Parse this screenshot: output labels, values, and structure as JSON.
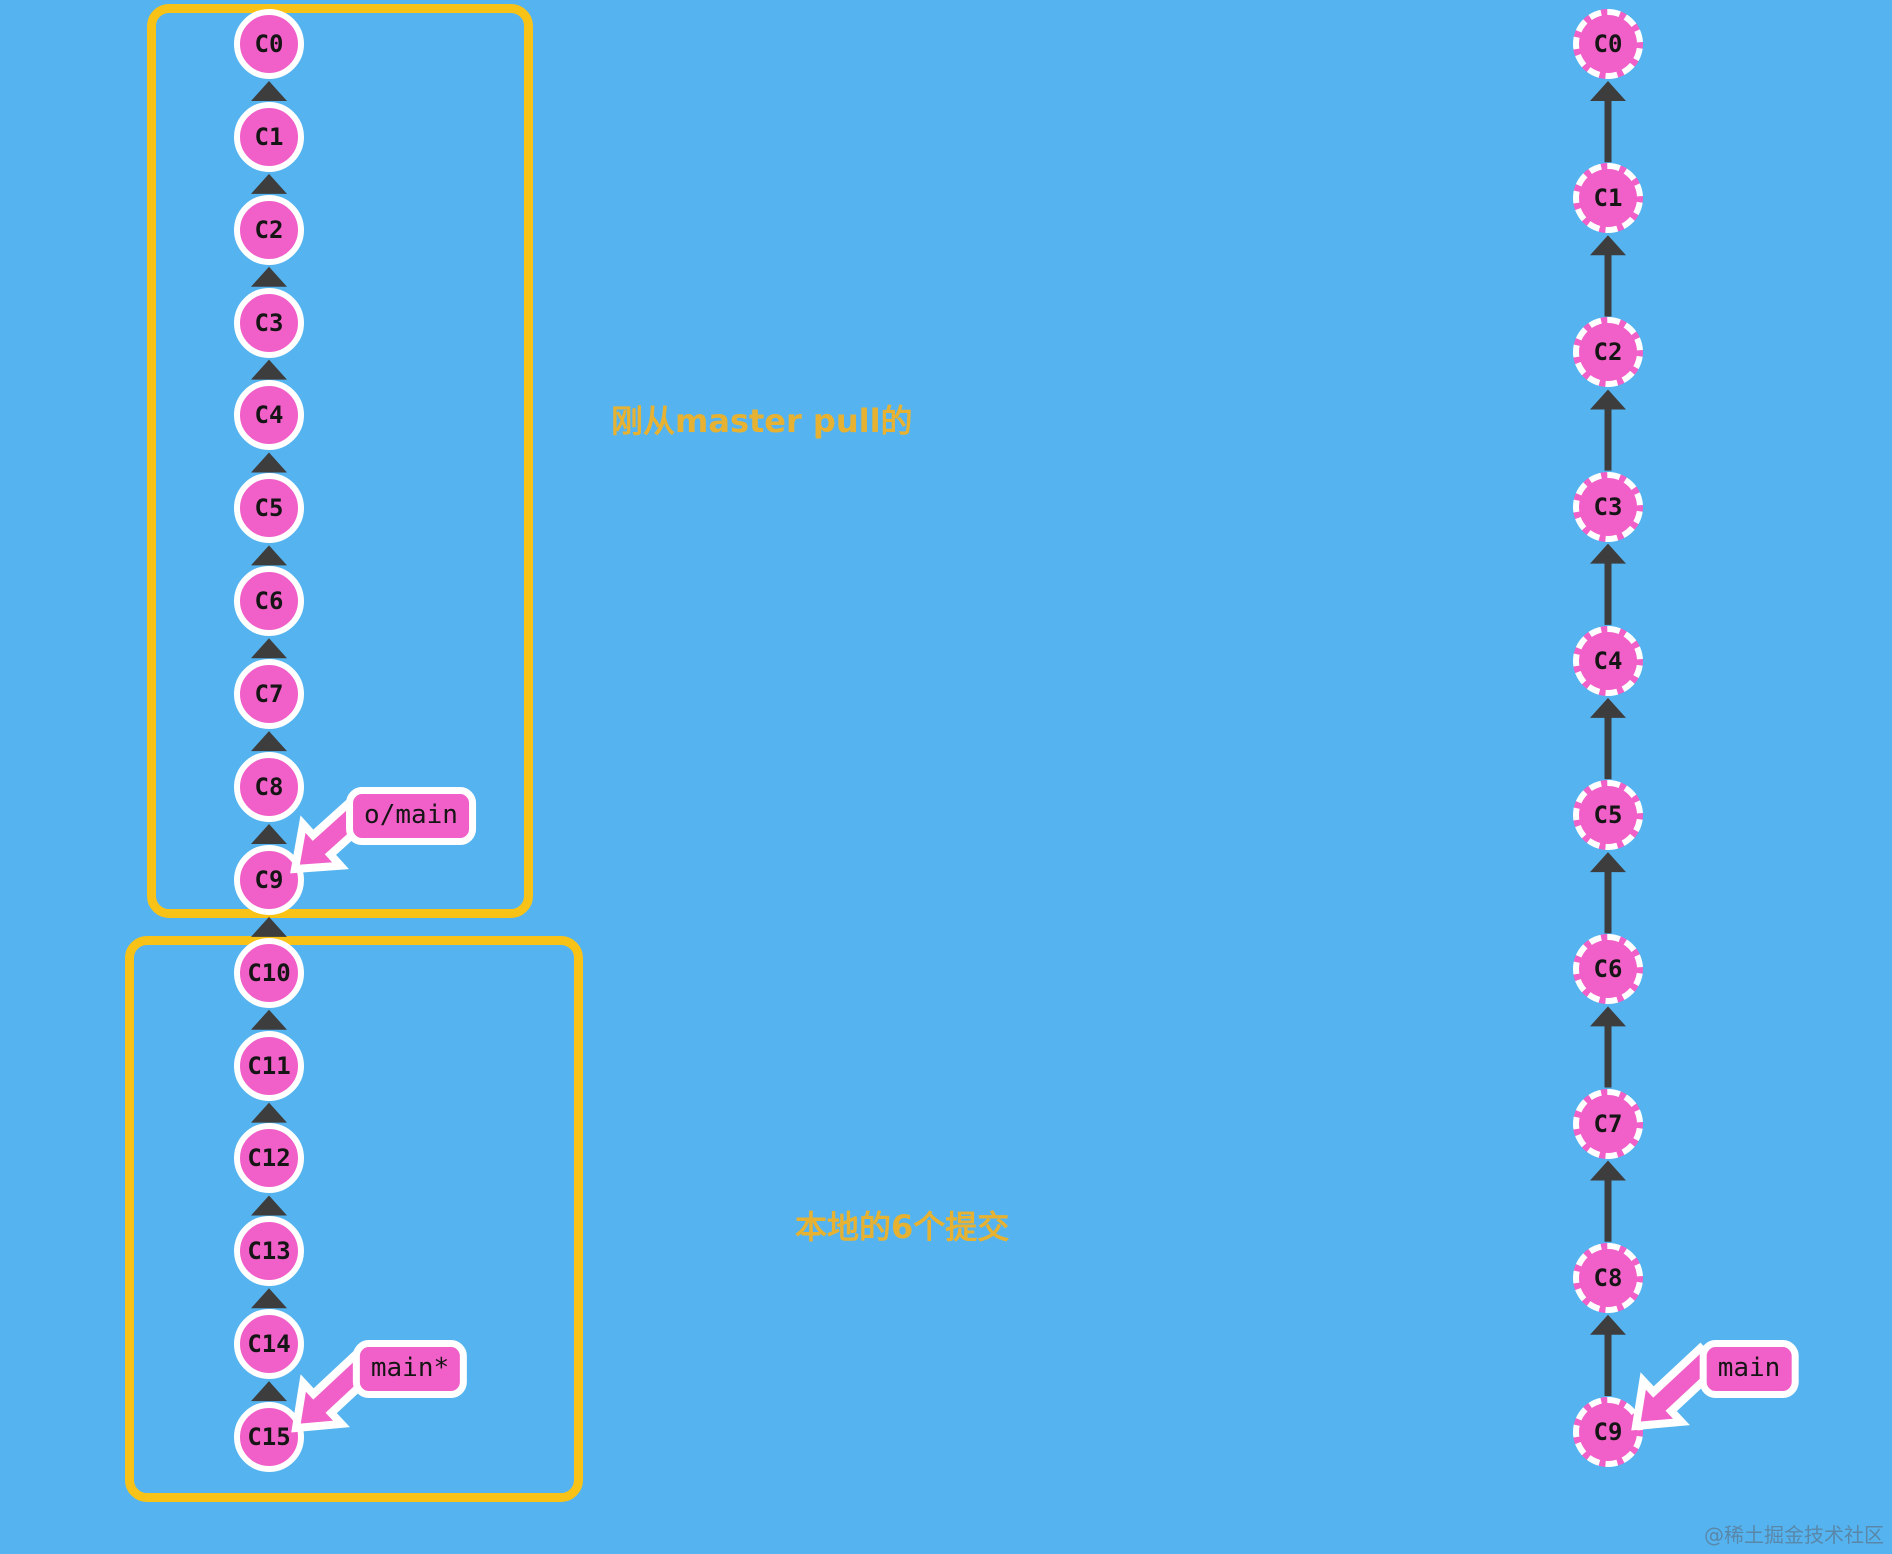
{
  "diagram": {
    "left_chain": {
      "description": "local repository commit chain",
      "commits": [
        "C0",
        "C1",
        "C2",
        "C3",
        "C4",
        "C5",
        "C6",
        "C7",
        "C8",
        "C9",
        "C10",
        "C11",
        "C12",
        "C13",
        "C14",
        "C15"
      ],
      "node_style": "solid"
    },
    "right_chain": {
      "description": "remote repository commit chain",
      "commits": [
        "C0",
        "C1",
        "C2",
        "C3",
        "C4",
        "C5",
        "C6",
        "C7",
        "C8",
        "C9"
      ],
      "node_style": "dashed"
    },
    "badges": {
      "remote_main": "o/main",
      "local_main": "main*",
      "right_main": "main"
    },
    "annotations": {
      "pulled_label": "刚从master pull的",
      "local_label": "本地的6个提交"
    },
    "colors": {
      "background": "#55b4f0",
      "commit_fill": "#f160c8",
      "commit_border": "#ffffff",
      "arrow": "#3d3d3d",
      "highlight_box": "#f9c216",
      "annotation_text": "#e7b232",
      "watermark": "#5d6470"
    }
  },
  "watermark": "@稀土掘金技术社区"
}
